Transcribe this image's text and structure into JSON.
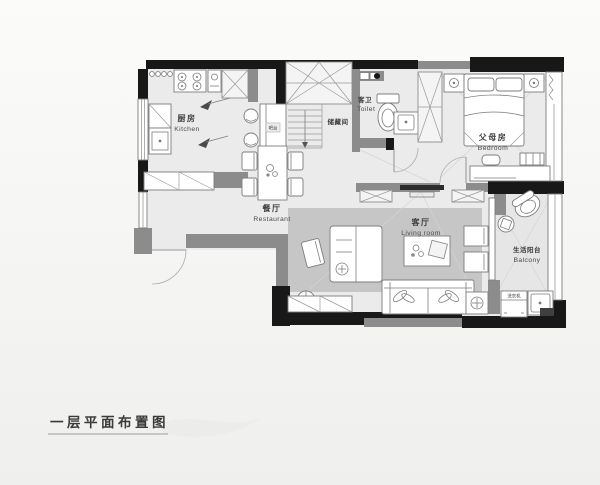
{
  "title": {
    "text": "一层平面布置图"
  },
  "rooms": {
    "kitchen": {
      "zh": "厨房",
      "en": "Kitchen"
    },
    "bar": {
      "zh": "吧台"
    },
    "storage": {
      "zh": "储藏间"
    },
    "toilet": {
      "zh": "客卫",
      "en": "Toilet"
    },
    "bedroom": {
      "zh": "父母房",
      "en": "Bedroom"
    },
    "dining": {
      "zh": "餐厅",
      "en": "Restaurant"
    },
    "living": {
      "zh": "客厅",
      "en": "Living room"
    },
    "balcony": {
      "zh": "生活阳台",
      "en": "Balcony"
    },
    "washer": {
      "zh": "洗衣机"
    }
  },
  "colors": {
    "background": "#f6f6f4",
    "floor": "#ebebeb",
    "balcony_floor": "#e6e6e6",
    "rug": "#c6c6c6",
    "wall": "#181818",
    "partition": "#8c8c8c",
    "furniture_line": "#7d7d7d",
    "label_text": "#3c3c3c"
  }
}
